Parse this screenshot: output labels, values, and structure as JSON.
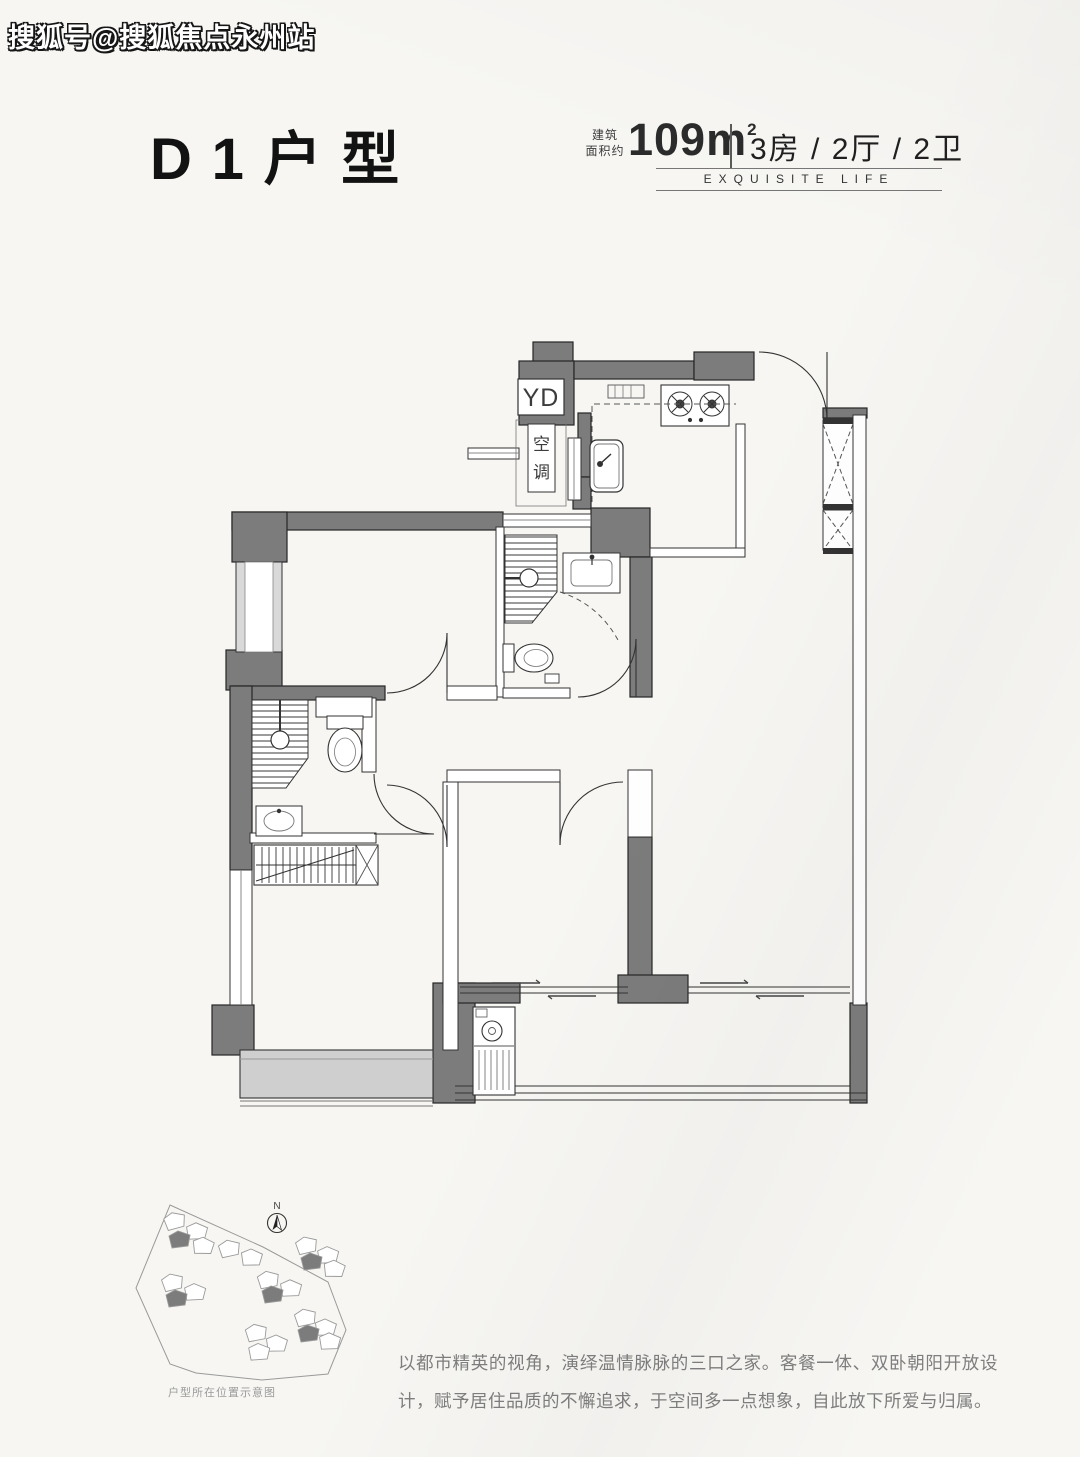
{
  "watermark": {
    "text": "搜狐号@搜狐焦点永州站"
  },
  "header": {
    "title": "D1户型"
  },
  "specs": {
    "area_label_l1": "建筑",
    "area_label_l2": "面积约",
    "area_value": "109m",
    "area_exponent": "2",
    "rooms": "3房 / 2厅 / 2卫",
    "tagline": "EXQUISITE LIFE"
  },
  "plan": {
    "label_yd": "YD",
    "label_ac_1": "空",
    "label_ac_2": "调"
  },
  "sitemap": {
    "north_label": "N",
    "caption": "户型所在位置示意图",
    "buildings": [
      {
        "x": 163,
        "y": 1214,
        "r": -8,
        "dark": false
      },
      {
        "x": 187,
        "y": 1222,
        "r": 5,
        "dark": false
      },
      {
        "x": 169,
        "y": 1231,
        "r": 0,
        "dark": true
      },
      {
        "x": 194,
        "y": 1236,
        "r": 8,
        "dark": false
      },
      {
        "x": 218,
        "y": 1241,
        "r": -5,
        "dark": false
      },
      {
        "x": 242,
        "y": 1248,
        "r": 6,
        "dark": false
      },
      {
        "x": 295,
        "y": 1238,
        "r": -6,
        "dark": false
      },
      {
        "x": 318,
        "y": 1246,
        "r": 4,
        "dark": false
      },
      {
        "x": 301,
        "y": 1253,
        "r": 0,
        "dark": true
      },
      {
        "x": 325,
        "y": 1259,
        "r": 8,
        "dark": false
      },
      {
        "x": 257,
        "y": 1272,
        "r": -4,
        "dark": false
      },
      {
        "x": 281,
        "y": 1279,
        "r": 5,
        "dark": false
      },
      {
        "x": 262,
        "y": 1286,
        "r": 0,
        "dark": true
      },
      {
        "x": 161,
        "y": 1275,
        "r": -6,
        "dark": false
      },
      {
        "x": 185,
        "y": 1283,
        "r": 4,
        "dark": false
      },
      {
        "x": 166,
        "y": 1290,
        "r": 0,
        "dark": true
      },
      {
        "x": 294,
        "y": 1310,
        "r": -5,
        "dark": false
      },
      {
        "x": 316,
        "y": 1318,
        "r": 6,
        "dark": false
      },
      {
        "x": 298,
        "y": 1325,
        "r": 0,
        "dark": true
      },
      {
        "x": 320,
        "y": 1332,
        "r": 5,
        "dark": false
      },
      {
        "x": 245,
        "y": 1325,
        "r": -4,
        "dark": false
      },
      {
        "x": 267,
        "y": 1334,
        "r": 6,
        "dark": false
      },
      {
        "x": 249,
        "y": 1343,
        "r": 3,
        "dark": false
      }
    ]
  },
  "description": {
    "text": "以都市精英的视角，演绎温情脉脉的三口之家。客餐一体、双卧朝阳开放设计，赋予居住品质的不懈追求，于空间多一点想象，自此放下所爱与归属。"
  },
  "colors": {
    "background": "#f7f6f3",
    "wall": "#7c7c7c",
    "line": "#2e2e2e",
    "window_light": "#d9d9d9",
    "bay_window": "#cfcfcf",
    "title_text": "#121212",
    "description_text": "#7e7e7e"
  }
}
